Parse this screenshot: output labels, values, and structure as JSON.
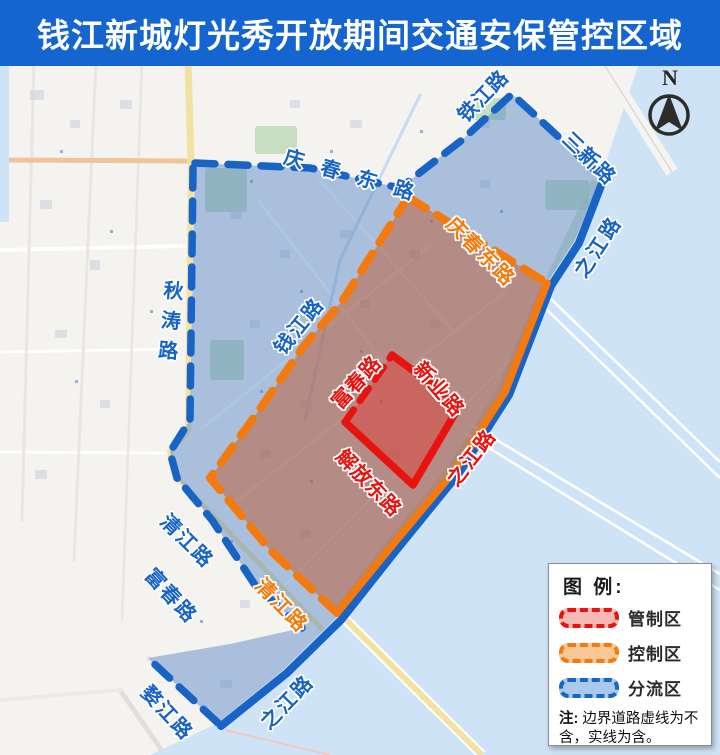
{
  "header": {
    "title": "钱江新城灯光秀开放期间交通安保管控区域",
    "bg": "#1465cf"
  },
  "north": {
    "label": "N"
  },
  "colors": {
    "header_bg": "#1465cf",
    "blue_line": "#1863c6",
    "orange_line": "#f57a0d",
    "red_line": "#e8130f",
    "river": "#cfe3f6",
    "blue_zone_fill": "rgba(77,129,195,0.45)",
    "orange_zone_fill": "rgba(194,86,38,0.48)",
    "red_zone_fill": "rgba(235,45,40,0.40)"
  },
  "legend": {
    "title": "图 例:",
    "items": [
      {
        "name": "restricted-zone",
        "label": "管制区",
        "line": "#e8130f",
        "fill": "#f4b8b5"
      },
      {
        "name": "control-zone",
        "label": "控制区",
        "line": "#f57a0d",
        "fill": "#f9c897"
      },
      {
        "name": "diversion-zone",
        "label": "分流区",
        "line": "#1766c4",
        "fill": "#a8c9e9"
      }
    ],
    "note_prefix": "注:",
    "note_text": " 边界道路虚线为不含，实线为含。"
  },
  "road_labels": [
    {
      "name": "qingchun-east-rd-blue",
      "text": "庆春东路",
      "x": 285,
      "y": 140,
      "rot": 16,
      "ls": 18,
      "color": "blue",
      "vertical": false
    },
    {
      "name": "tiejiang-rd",
      "text": "铁江路",
      "x": 460,
      "y": 103,
      "rot": -46,
      "ls": 1,
      "color": "blue",
      "vertical": false
    },
    {
      "name": "sanxin-rd",
      "text": "三新路",
      "x": 567,
      "y": 120,
      "rot": 44,
      "ls": 2,
      "color": "blue",
      "vertical": false
    },
    {
      "name": "zhijiang-rd-north",
      "text": "之江路",
      "x": 578,
      "y": 260,
      "rot": -57,
      "ls": 3,
      "color": "blue",
      "vertical": false
    },
    {
      "name": "qingchun-east-rd-orange",
      "text": "庆春东路",
      "x": 451,
      "y": 205,
      "rot": 45,
      "ls": 2,
      "color": "orange",
      "vertical": false
    },
    {
      "name": "qianjiang-rd",
      "text": "钱江路",
      "x": 277,
      "y": 336,
      "rot": -51,
      "ls": 2,
      "color": "blue",
      "vertical": false
    },
    {
      "name": "qiutao-rd",
      "text": "秋涛路",
      "x": 158,
      "y": 280,
      "rot": 5,
      "ls": 10,
      "color": "blue",
      "vertical": true
    },
    {
      "name": "fuchun-rd-red",
      "text": "富春路",
      "x": 334,
      "y": 390,
      "rot": -48,
      "ls": 1,
      "color": "red",
      "vertical": false
    },
    {
      "name": "xinye-rd",
      "text": "新业路",
      "x": 419,
      "y": 349,
      "rot": 49,
      "ls": 2,
      "color": "red",
      "vertical": false
    },
    {
      "name": "jiefang-east-rd",
      "text": "解放东路",
      "x": 341,
      "y": 437,
      "rot": 46,
      "ls": 1,
      "color": "red",
      "vertical": false
    },
    {
      "name": "zhijiang-rd-mid",
      "text": "之江路",
      "x": 450,
      "y": 468,
      "rot": -52,
      "ls": 2,
      "color": "red",
      "vertical": false
    },
    {
      "name": "qingjiang-rd-orange",
      "text": "清江路",
      "x": 260,
      "y": 566,
      "rot": 46,
      "ls": 2,
      "color": "orange",
      "vertical": false
    },
    {
      "name": "qingjiang-rd-blue",
      "text": "清江路",
      "x": 165,
      "y": 502,
      "rot": 45,
      "ls": 2,
      "color": "blue",
      "vertical": false
    },
    {
      "name": "fuchun-rd-blue",
      "text": "富春路",
      "x": 150,
      "y": 556,
      "rot": 47,
      "ls": 2,
      "color": "blue",
      "vertical": false
    },
    {
      "name": "wujiang-rd",
      "text": "婺江路",
      "x": 146,
      "y": 673,
      "rot": 47,
      "ls": 2,
      "color": "blue",
      "vertical": false
    },
    {
      "name": "zhijiang-rd-south",
      "text": "之江路",
      "x": 263,
      "y": 710,
      "rot": -46,
      "ls": 2,
      "color": "blue",
      "vertical": false
    }
  ]
}
